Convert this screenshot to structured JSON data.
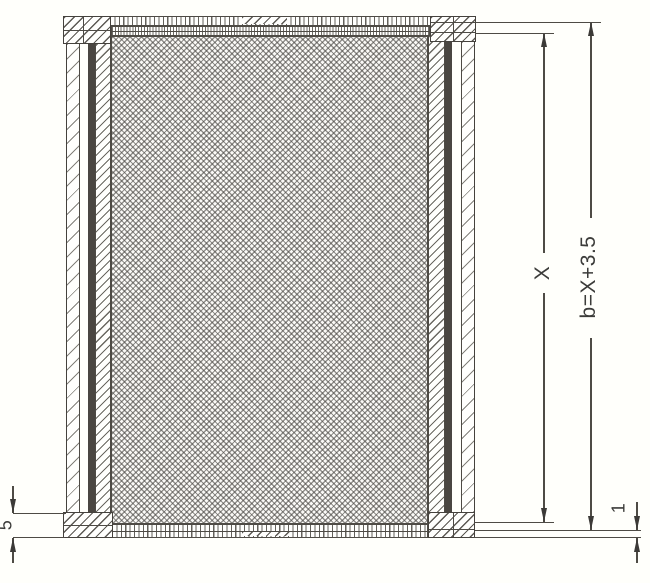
{
  "figure": {
    "kind": "frame-cross-section-drawing",
    "dimensions": {
      "inner_height": {
        "label": "X"
      },
      "overall_height": {
        "label": "b=X+3.5"
      },
      "bottom_bar_thickness": {
        "label": "5"
      },
      "bottom_clearance": {
        "label": "1"
      }
    },
    "colors": {
      "line": "#4e4b45",
      "wire_groove": "#4a4641",
      "background": "#fffffb"
    }
  }
}
